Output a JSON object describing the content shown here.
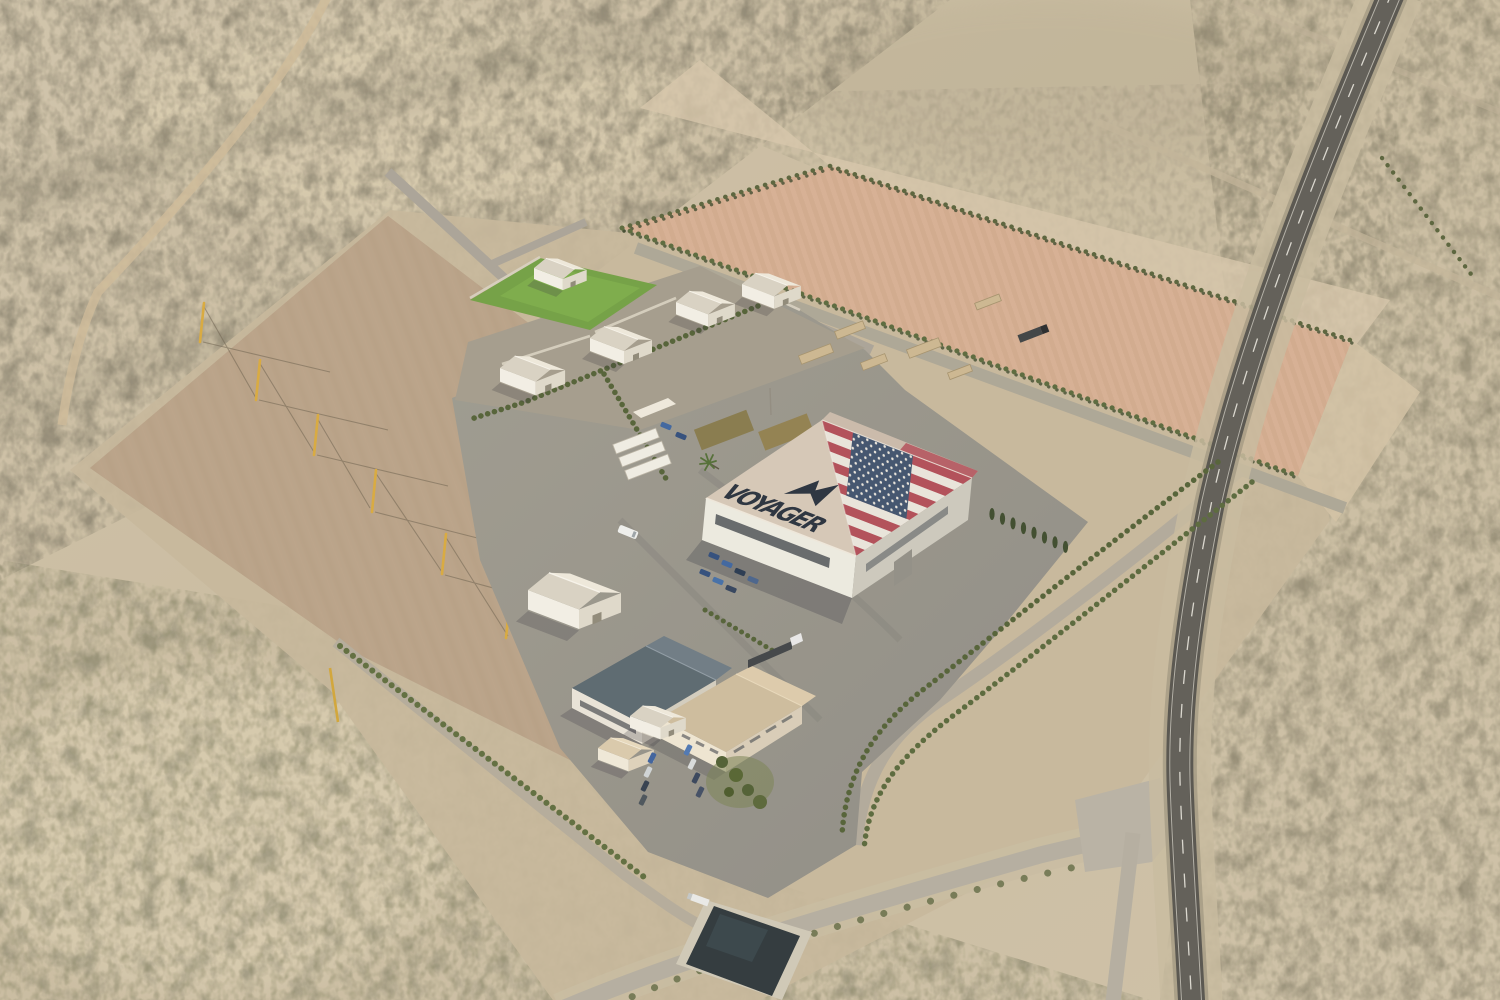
{
  "scene": {
    "title": "Aerial rendering of Voyager desert manufacturing campus",
    "environment": "desert scrubland with graded construction pads",
    "view": "oblique aerial, late-day light, sun from upper right",
    "ground_features": [
      "tilled pink field bordered by tree rows",
      "graded dirt pad with utility poles",
      "paved concrete apron",
      "curving asphalt highway",
      "access roads",
      "retention pond"
    ]
  },
  "branding": {
    "roof_text": "VOYAGER",
    "logo": "voyager-wing-logo",
    "flag": "united-states-flag-roof-mural"
  },
  "facility": {
    "main_building": "large hangar with US flag and VOYAGER wordmark painted on roof",
    "support_buildings_count": 6,
    "admin_buildings_count": 5,
    "storage_containers_count": 3,
    "utility_pole_count": 6,
    "cypress_tree_count": 8,
    "parked_cars_hangar_lot": 7,
    "parked_cars_admin_lot": 8,
    "trucks_count": 3,
    "vans_count": 1,
    "laydown_blocks_count": 6,
    "lawn": "green landscaped lawn at north support compound",
    "pond": "dark retention basin at south access road"
  },
  "colors": {
    "desert_base": "#cdc1a9",
    "scrub_dark": "#6f6a5a",
    "pad_dirt": "#b6a28a",
    "field_pink": "#d5ad92",
    "apron_gray": "#94928b",
    "road_gray": "#aba596",
    "highway_asphalt": "#4f4d49",
    "roof_tan": "#d5c7b8",
    "flag_red": "#b04a57",
    "flag_white": "#e9e5de",
    "flag_blue": "#3c4f6d",
    "hedge_green": "#4c5a33",
    "lawn_green": "#6f9f42",
    "logo_navy": "#242d3c"
  }
}
